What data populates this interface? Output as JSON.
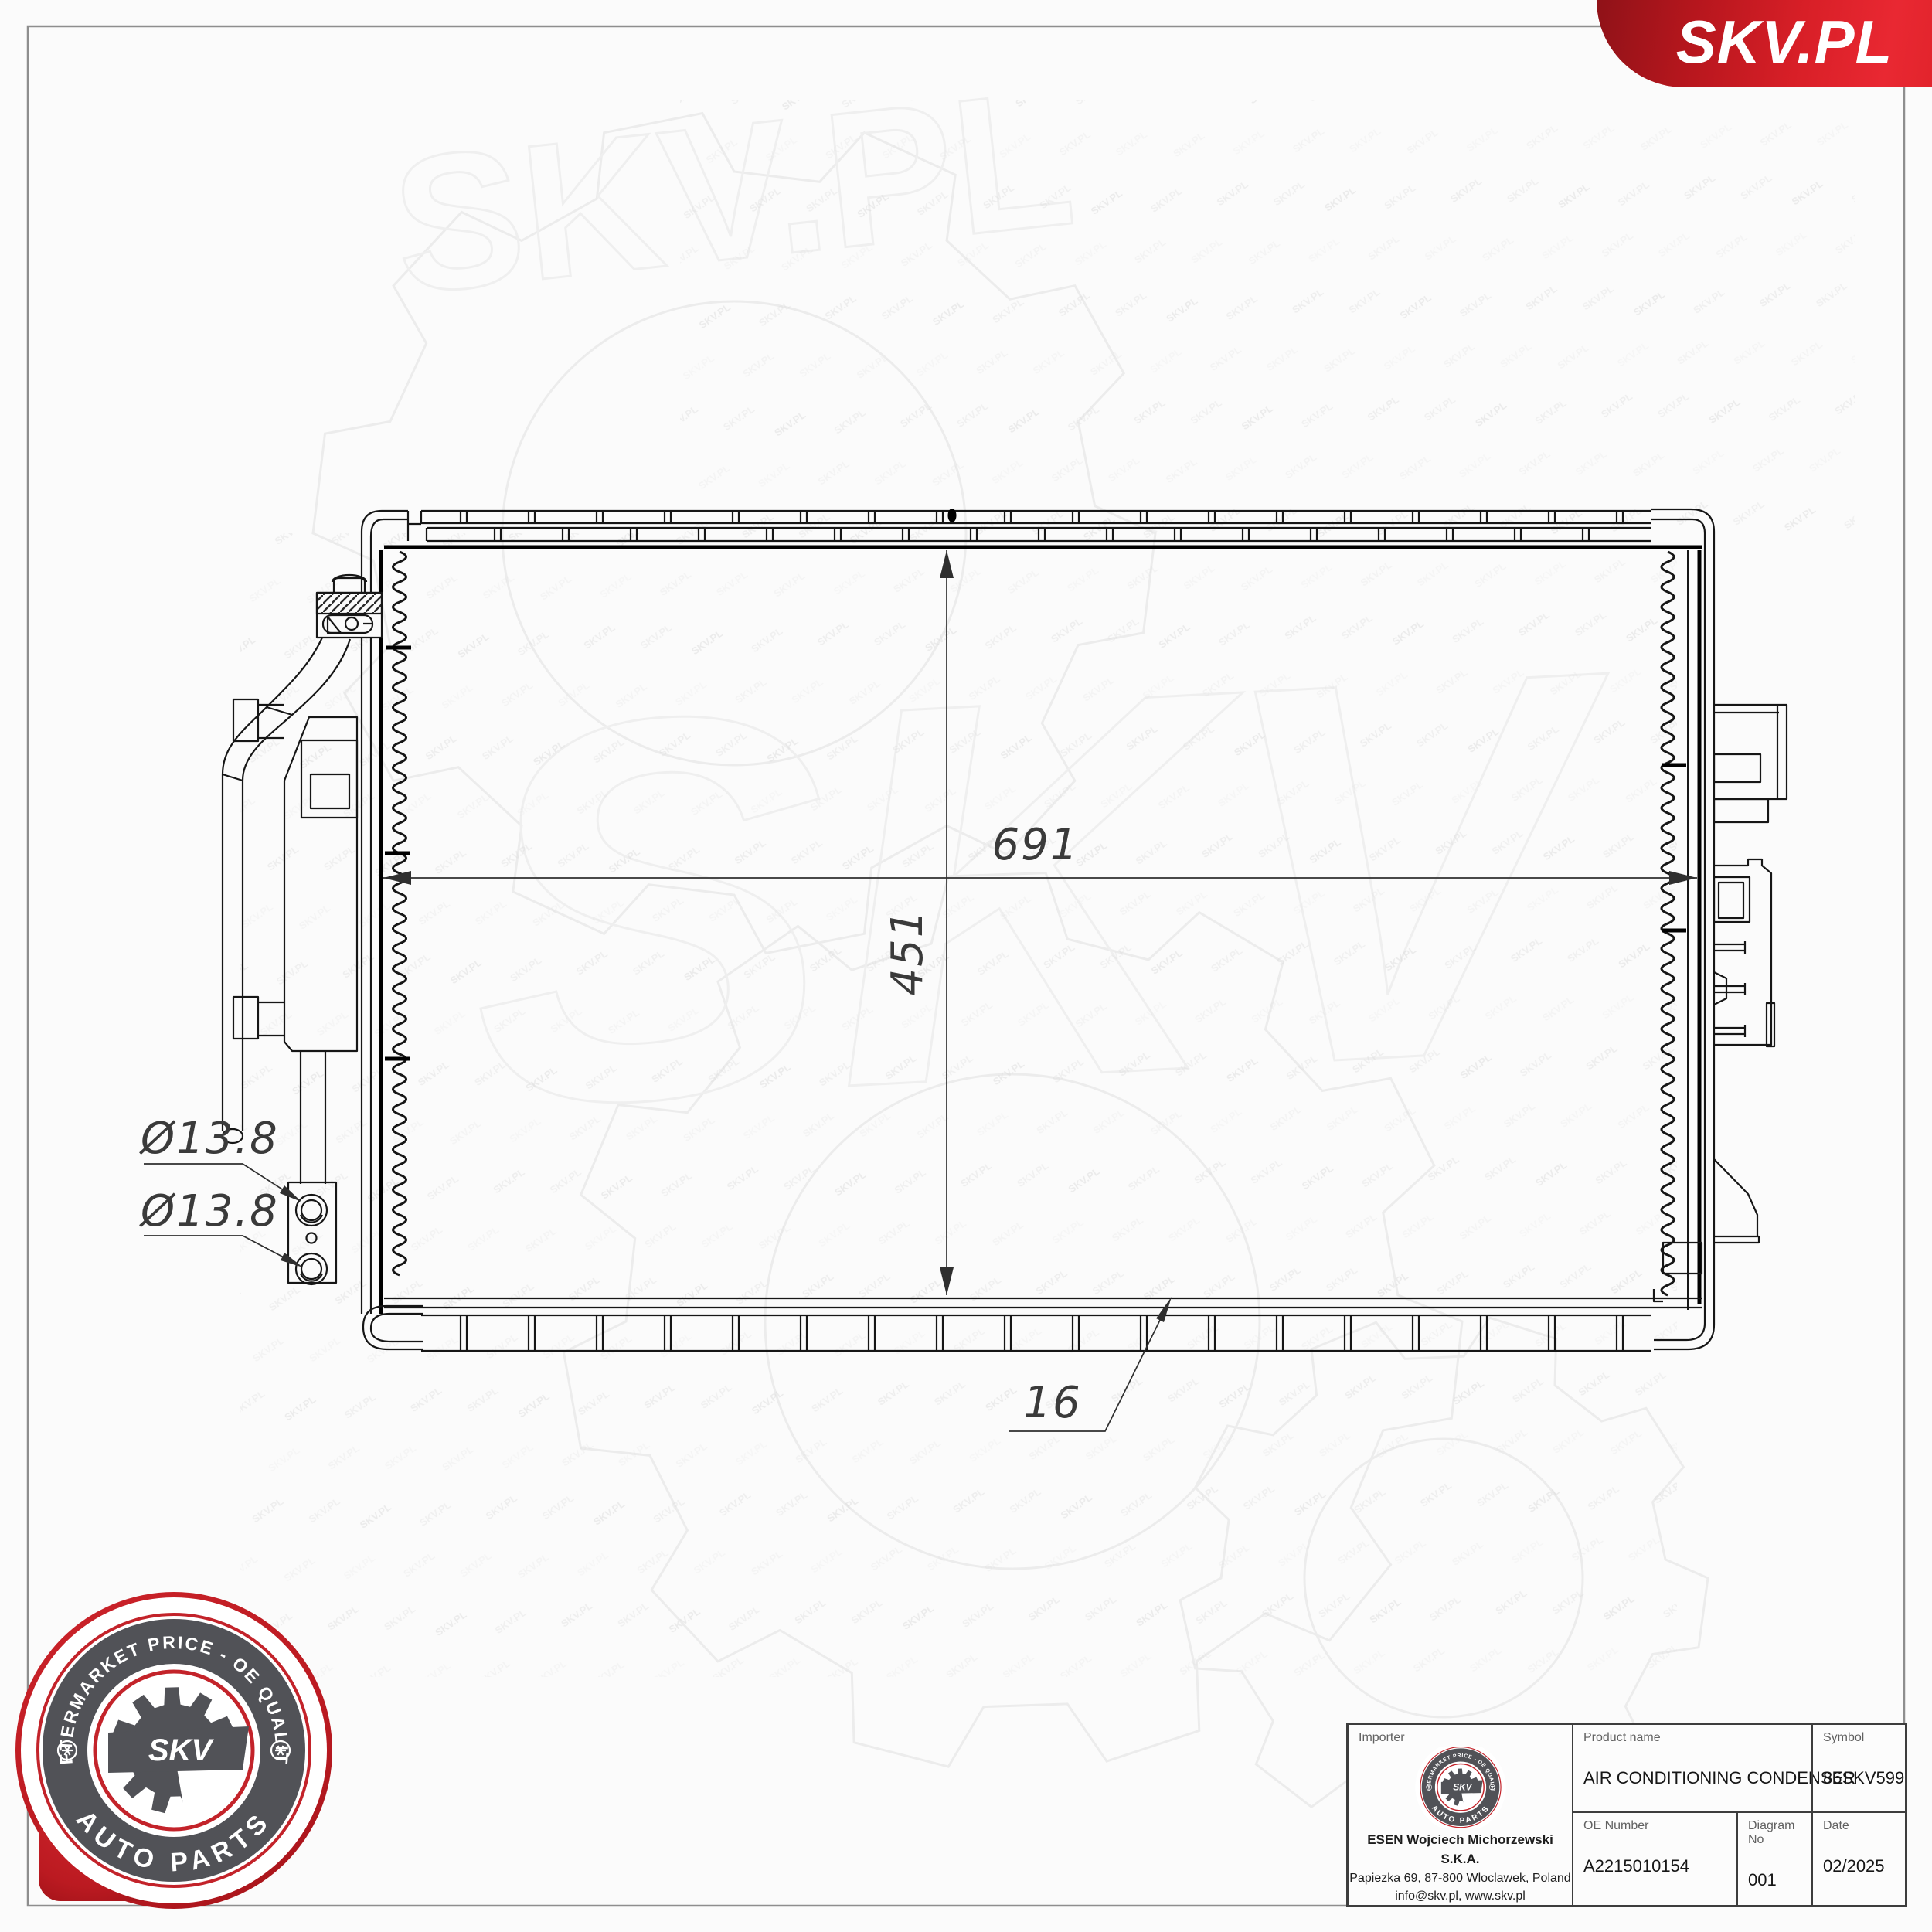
{
  "brand": {
    "logo_text": "SKV.PL",
    "banner_color_main": "#d81f27",
    "banner_color_dark": "#8f1218"
  },
  "stamp": {
    "ring_text_top": "AFTERMARKET PRICE - OE QUALITY",
    "ring_text_bottom": "AUTO PARTS",
    "center_text": "SKV",
    "red": "#c3232a",
    "gray": "#515257"
  },
  "watermark": {
    "tile_text": "SKV.PL",
    "big_text": "SKV",
    "big_text2": "SKV.PL"
  },
  "drawing": {
    "dimensions": {
      "width_label": "691",
      "height_label": "451",
      "thickness_label": "16",
      "port_top_label": "Ø13.8",
      "port_bottom_label": "Ø13.8"
    }
  },
  "title_block": {
    "importer": {
      "label": "Importer",
      "company": "ESEN Wojciech Michorzewski S.K.A.",
      "address": "Papiezka 69, 87-800 Wloclawek, Poland",
      "contact": "info@skv.pl, www.skv.pl"
    },
    "product": {
      "label": "Product name",
      "value": "AIR CONDITIONING CONDENSER"
    },
    "symbol": {
      "label": "Symbol",
      "value": "86SKV599"
    },
    "oe_number": {
      "label": "OE Number",
      "value": "A2215010154"
    },
    "diagram_no": {
      "label": "Diagram No",
      "value": "001"
    },
    "date": {
      "label": "Date",
      "value": "02/2025"
    }
  }
}
